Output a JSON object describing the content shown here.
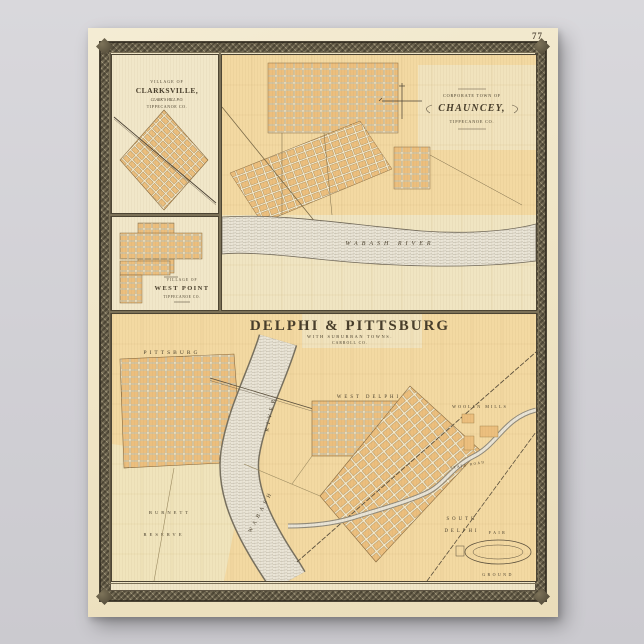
{
  "page": {
    "number": "77"
  },
  "insets": {
    "clarksville": {
      "heading": "VILLAGE OF",
      "name": "CLARKSVILLE,",
      "po": "CLARK'S HILL P.O.",
      "county": "TIPPECANOE CO."
    },
    "west_point": {
      "heading": "VILLAGE OF",
      "name": "WEST POINT",
      "county": "TIPPECANOE CO."
    },
    "chauncey": {
      "heading": "CORPORATE TOWN OF",
      "name": "CHAUNCEY,",
      "county": "TIPPECANOE CO.",
      "river": "WABASH  RIVER"
    }
  },
  "main": {
    "title": "DELPHI & PITTSBURG",
    "subtitle": "WITH SUBURBAN TOWNS.",
    "county": "CARROLL CO.",
    "labels": {
      "pittsburg": "PITTSBURG",
      "west_delphi": "WEST DELPHI",
      "river_name": "WABASH",
      "river_word": "RIVER",
      "woolen_mills": "WOOLEN MILLS",
      "south": "SOUTH",
      "delphi": "DELPHI",
      "fair": "FAIR",
      "ground": "GROUND",
      "burnett": "BURNETT",
      "reserve": "RESERVE",
      "state_road": "STATE ROAD"
    }
  },
  "colors": {
    "background_gray": "#d2d1d5",
    "paper_cream": "#f0e6c8",
    "map_wash_orange": "#f3d9a2",
    "block_orange": "#ecbf7e",
    "river_fill": "#eae5d7",
    "border_braid": "#675f4b",
    "ink": "#473d2b"
  }
}
